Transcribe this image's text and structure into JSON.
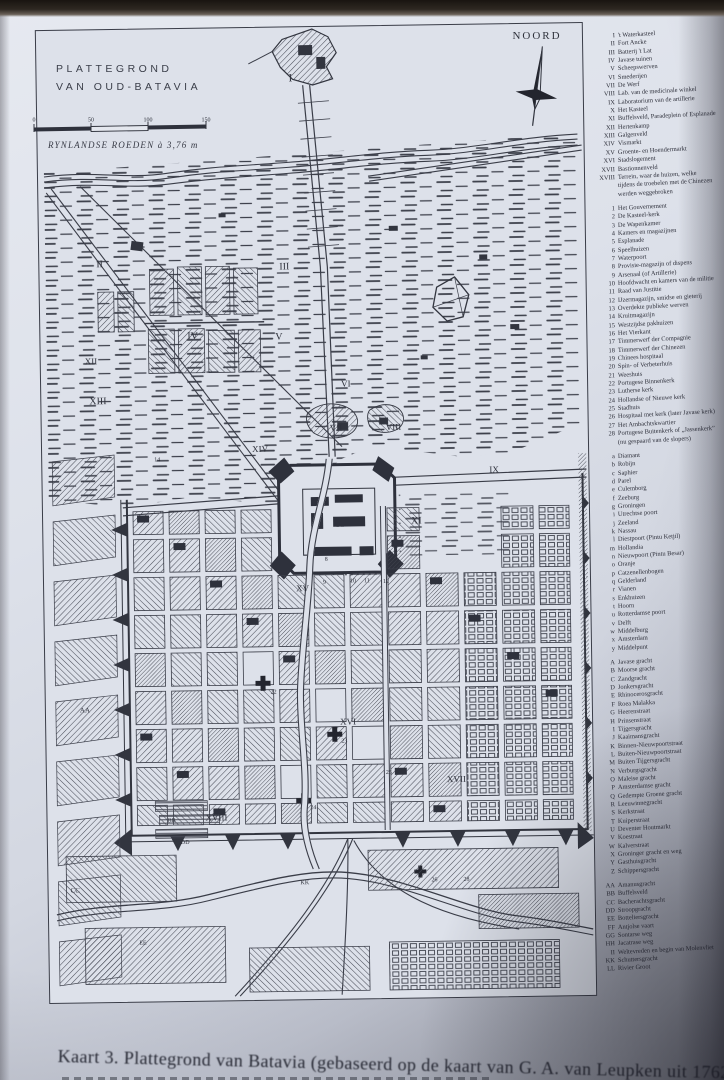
{
  "page": {
    "map_title_line1": "PLATTEGROND",
    "map_title_line2": "VAN OUD-BATAVIA",
    "compass_label": "NOORD",
    "scale": {
      "ticks": [
        "0",
        "50",
        "100",
        "150"
      ],
      "caption": "RYNLANDSE ROEDEN à 3,76 m"
    },
    "caption": "Kaart 3. Plattegrond van Batavia (gebaseerd op de kaart van G. A. van Leupken uit 1762).",
    "colors": {
      "page": "#dde1ea",
      "ink": "#3a3d48"
    }
  },
  "map": {
    "labels": [
      {
        "t": "I",
        "x": 252,
        "y": 54,
        "s": 11
      },
      {
        "t": "II",
        "x": 57,
        "y": 237,
        "s": 10
      },
      {
        "t": "III",
        "x": 240,
        "y": 242,
        "s": 10
      },
      {
        "t": "IV",
        "x": 147,
        "y": 310,
        "s": 10
      },
      {
        "t": "V",
        "x": 235,
        "y": 312,
        "s": 10
      },
      {
        "t": "VI",
        "x": 300,
        "y": 360,
        "s": 9
      },
      {
        "t": "VII",
        "x": 288,
        "y": 404,
        "s": 9
      },
      {
        "t": "VIII",
        "x": 344,
        "y": 404,
        "s": 9
      },
      {
        "t": "IX",
        "x": 447,
        "y": 448,
        "s": 9
      },
      {
        "t": "X",
        "x": 293,
        "y": 500,
        "s": 11
      },
      {
        "t": "XI",
        "x": 368,
        "y": 498,
        "s": 10
      },
      {
        "t": "XII",
        "x": 44,
        "y": 334,
        "s": 9
      },
      {
        "t": "XIII",
        "x": 48,
        "y": 374,
        "s": 10
      },
      {
        "t": "XIV",
        "x": 210,
        "y": 424,
        "s": 9
      },
      {
        "t": "XV",
        "x": 252,
        "y": 564,
        "s": 9
      },
      {
        "t": "XVI",
        "x": 294,
        "y": 698,
        "s": 9
      },
      {
        "t": "XVII",
        "x": 400,
        "y": 757,
        "s": 9
      },
      {
        "t": "XVIII",
        "x": 158,
        "y": 792,
        "s": 9
      },
      {
        "t": "14",
        "x": 112,
        "y": 432,
        "s": 6
      },
      {
        "t": "8",
        "x": 281,
        "y": 534,
        "s": 6
      },
      {
        "t": "9",
        "x": 279,
        "y": 557,
        "s": 6
      },
      {
        "t": "10",
        "x": 306,
        "y": 556,
        "s": 6
      },
      {
        "t": "11",
        "x": 320,
        "y": 556,
        "s": 6
      },
      {
        "t": "12",
        "x": 339,
        "y": 557,
        "s": 6
      },
      {
        "t": "22",
        "x": 225,
        "y": 666,
        "s": 6
      },
      {
        "t": "23",
        "x": 295,
        "y": 716,
        "s": 6
      },
      {
        "t": "24",
        "x": 263,
        "y": 782,
        "s": 6
      },
      {
        "t": "25",
        "x": 339,
        "y": 748,
        "s": 6
      },
      {
        "t": "26",
        "x": 383,
        "y": 856,
        "s": 6
      },
      {
        "t": "28",
        "x": 415,
        "y": 856,
        "s": 6
      },
      {
        "t": "AA",
        "x": 34,
        "y": 682,
        "s": 7
      },
      {
        "t": "BB",
        "x": 120,
        "y": 793,
        "s": 6
      },
      {
        "t": "CC",
        "x": 22,
        "y": 862,
        "s": 7
      },
      {
        "t": "DD",
        "x": 133,
        "y": 815,
        "s": 6
      },
      {
        "t": "KK",
        "x": 252,
        "y": 857,
        "s": 6
      },
      {
        "t": "EE",
        "x": 90,
        "y": 915,
        "s": 6
      }
    ]
  },
  "legend": {
    "groups": [
      {
        "name": "roman-areas",
        "items": [
          {
            "k": "I",
            "v": [
              "'t Waterkasteel"
            ]
          },
          {
            "k": "II",
            "v": [
              "Fort Ancke"
            ]
          },
          {
            "k": "III",
            "v": [
              "Batterij 't Lat"
            ]
          },
          {
            "k": "IV",
            "v": [
              "Javase tuinen"
            ]
          },
          {
            "k": "V",
            "v": [
              "Scheepswerven"
            ]
          },
          {
            "k": "VI",
            "v": [
              "Smederijen"
            ]
          },
          {
            "k": "VII",
            "v": [
              "De Werf"
            ]
          },
          {
            "k": "VIII",
            "v": [
              "Lab. van de medicinale winkel"
            ]
          },
          {
            "k": "IX",
            "v": [
              "Laboratorium van de artillerie"
            ]
          },
          {
            "k": "X",
            "v": [
              "Het Kasteel"
            ]
          },
          {
            "k": "XI",
            "v": [
              "Buffelsveld, Paradeplein of Esplanade"
            ]
          },
          {
            "k": "XII",
            "v": [
              "Hertenkamp"
            ]
          },
          {
            "k": "XIII",
            "v": [
              "Galgenveld"
            ]
          },
          {
            "k": "XIV",
            "v": [
              "Vismarkt"
            ]
          },
          {
            "k": "XV",
            "v": [
              "Groente- en Hoendermarkt"
            ]
          },
          {
            "k": "XVI",
            "v": [
              "Stadslogement"
            ]
          },
          {
            "k": "XVII",
            "v": [
              "Bastionnenveld"
            ]
          },
          {
            "k": "XVIII",
            "v": [
              "Terrein, waar de huizen, welke",
              "tijdens de troebelen met de Chinezen",
              "werden weggebroken"
            ]
          }
        ]
      },
      {
        "name": "numbered-buildings",
        "items": [
          {
            "k": "1",
            "v": [
              "Het Gouvernement"
            ]
          },
          {
            "k": "2",
            "v": [
              "De Kasteel-kerk"
            ]
          },
          {
            "k": "3",
            "v": [
              "De Wapenkamer"
            ]
          },
          {
            "k": "4",
            "v": [
              "Kamers en magazijnen"
            ]
          },
          {
            "k": "5",
            "v": [
              "Esplanade"
            ]
          },
          {
            "k": "6",
            "v": [
              "Speelhuizen"
            ]
          },
          {
            "k": "7",
            "v": [
              "Waterpoort"
            ]
          },
          {
            "k": "8",
            "v": [
              "Provisie-magazijn of dispens"
            ]
          },
          {
            "k": "9",
            "v": [
              "Arsenaal (of Artillerie)"
            ]
          },
          {
            "k": "10",
            "v": [
              "Hoofdwacht en kamers van de militie"
            ]
          },
          {
            "k": "11",
            "v": [
              "Raad van Justitie"
            ]
          },
          {
            "k": "12",
            "v": [
              "IJzermagazijn, smidse en gieterij"
            ]
          },
          {
            "k": "13",
            "v": [
              "Overdekte publieke werven"
            ]
          },
          {
            "k": "14",
            "v": [
              "Kruitmagazijn"
            ]
          },
          {
            "k": "15",
            "v": [
              "Westzijdse pakhuizen"
            ]
          },
          {
            "k": "16",
            "v": [
              "Het Vierkant"
            ]
          },
          {
            "k": "17",
            "v": [
              "Timmerwerf der Compagnie"
            ]
          },
          {
            "k": "18",
            "v": [
              "Timmerwerf der Chinezen"
            ]
          },
          {
            "k": "19",
            "v": [
              "Chinees hospitaal"
            ]
          },
          {
            "k": "20",
            "v": [
              "Spin- of Verbeterhuis"
            ]
          },
          {
            "k": "21",
            "v": [
              "Weeshuis"
            ]
          },
          {
            "k": "22",
            "v": [
              "Portugese Binnenkerk"
            ]
          },
          {
            "k": "23",
            "v": [
              "Lutherse kerk"
            ]
          },
          {
            "k": "24",
            "v": [
              "Hollandse of Nieuwe kerk"
            ]
          },
          {
            "k": "25",
            "v": [
              "Stadhuis"
            ]
          },
          {
            "k": "26",
            "v": [
              "Hospitaal met kerk (later Javase kerk)"
            ]
          },
          {
            "k": "27",
            "v": [
              "Het Ambachtskwartier"
            ]
          },
          {
            "k": "28",
            "v": [
              "Portugese Buitenkerk of „Jassenkerk”",
              "(nu gespaard van de slopers)"
            ]
          }
        ]
      },
      {
        "name": "bastions-gates",
        "items": [
          {
            "k": "a",
            "v": [
              "Diamant"
            ]
          },
          {
            "k": "b",
            "v": [
              "Robijn"
            ]
          },
          {
            "k": "c",
            "v": [
              "Saphier"
            ]
          },
          {
            "k": "d",
            "v": [
              "Parel"
            ]
          },
          {
            "k": "e",
            "v": [
              "Culemborg"
            ]
          },
          {
            "k": "f",
            "v": [
              "Zeeburg"
            ]
          },
          {
            "k": "g",
            "v": [
              "Groningen"
            ]
          },
          {
            "k": "i",
            "v": [
              "Utrechtse poort"
            ]
          },
          {
            "k": "j",
            "v": [
              "Zeeland"
            ]
          },
          {
            "k": "k",
            "v": [
              "Nassau"
            ]
          },
          {
            "k": "l",
            "v": [
              "Diestpoort (Pintu Ketjil)"
            ]
          },
          {
            "k": "m",
            "v": [
              "Hollandia"
            ]
          },
          {
            "k": "n",
            "v": [
              "Nieuwpoort (Pintu Besar)"
            ]
          },
          {
            "k": "o",
            "v": [
              "Oranje"
            ]
          },
          {
            "k": "p",
            "v": [
              "Catzenellenbogen"
            ]
          },
          {
            "k": "q",
            "v": [
              "Gelderland"
            ]
          },
          {
            "k": "r",
            "v": [
              "Vianen"
            ]
          },
          {
            "k": "s",
            "v": [
              "Enkhuizen"
            ]
          },
          {
            "k": "t",
            "v": [
              "Hoorn"
            ]
          },
          {
            "k": "u",
            "v": [
              "Rotterdamse poort"
            ]
          },
          {
            "k": "v",
            "v": [
              "Delft"
            ]
          },
          {
            "k": "w",
            "v": [
              "Middelburg"
            ]
          },
          {
            "k": "x",
            "v": [
              "Amsterdam"
            ]
          },
          {
            "k": "y",
            "v": [
              "Middelpunt"
            ]
          }
        ]
      },
      {
        "name": "streets-canals",
        "items": [
          {
            "k": "A",
            "v": [
              "Javase gracht"
            ]
          },
          {
            "k": "B",
            "v": [
              "Moorse gracht"
            ]
          },
          {
            "k": "C",
            "v": [
              "Zandgracht"
            ]
          },
          {
            "k": "D",
            "v": [
              "Jonkersgracht"
            ]
          },
          {
            "k": "E",
            "v": [
              "Rhinocerosgracht"
            ]
          },
          {
            "k": "F",
            "v": [
              "Roea Malakka"
            ]
          },
          {
            "k": "G",
            "v": [
              "Heerenstraat"
            ]
          },
          {
            "k": "H",
            "v": [
              "Prinsenstraat"
            ]
          },
          {
            "k": "I",
            "v": [
              "Tijgersgracht"
            ]
          },
          {
            "k": "J",
            "v": [
              "Kaaimansgracht"
            ]
          },
          {
            "k": "K",
            "v": [
              "Binnen-Nieuwpoortstraat"
            ]
          },
          {
            "k": "L",
            "v": [
              "Buiten-Nieuwpoortstraat"
            ]
          },
          {
            "k": "M",
            "v": [
              "Buiten Tijgersgracht"
            ]
          },
          {
            "k": "N",
            "v": [
              "Verburgsgracht"
            ]
          },
          {
            "k": "O",
            "v": [
              "Maleise gracht"
            ]
          },
          {
            "k": "P",
            "v": [
              "Amsterdamse gracht"
            ]
          },
          {
            "k": "Q",
            "v": [
              "Gedempte Groene gracht"
            ]
          },
          {
            "k": "R",
            "v": [
              "Leeuwinnegracht"
            ]
          },
          {
            "k": "S",
            "v": [
              "Kerkstraat"
            ]
          },
          {
            "k": "T",
            "v": [
              "Kuiperstraat"
            ]
          },
          {
            "k": "U",
            "v": [
              "Deventer Houtmarkt"
            ]
          },
          {
            "k": "V",
            "v": [
              "Koestraat"
            ]
          },
          {
            "k": "W",
            "v": [
              "Kalverstraat"
            ]
          },
          {
            "k": "X",
            "v": [
              "Groninger gracht en weg"
            ]
          },
          {
            "k": "Y",
            "v": [
              "Gasthuisgracht"
            ]
          },
          {
            "k": "Z",
            "v": [
              "Schippersgracht"
            ]
          }
        ]
      },
      {
        "name": "outer-areas",
        "items": [
          {
            "k": "AA",
            "v": [
              "Amanusgracht"
            ]
          },
          {
            "k": "BB",
            "v": [
              "Buffelsveld"
            ]
          },
          {
            "k": "CC",
            "v": [
              "Bacherachtsgracht"
            ]
          },
          {
            "k": "DD",
            "v": [
              "Stroopgracht"
            ]
          },
          {
            "k": "EE",
            "v": [
              "Botteliersgracht"
            ]
          },
          {
            "k": "FF",
            "v": [
              "Antjolse vaart"
            ]
          },
          {
            "k": "GG",
            "v": [
              "Sontarse weg"
            ]
          },
          {
            "k": "HH",
            "v": [
              "Jacatrase weg"
            ]
          },
          {
            "k": "II",
            "v": [
              "Weltevreden en begin van Molenvliet"
            ]
          },
          {
            "k": "KK",
            "v": [
              "Schuttersgracht"
            ]
          },
          {
            "k": "LL",
            "v": [
              "Rivier Groot"
            ]
          }
        ]
      }
    ]
  }
}
